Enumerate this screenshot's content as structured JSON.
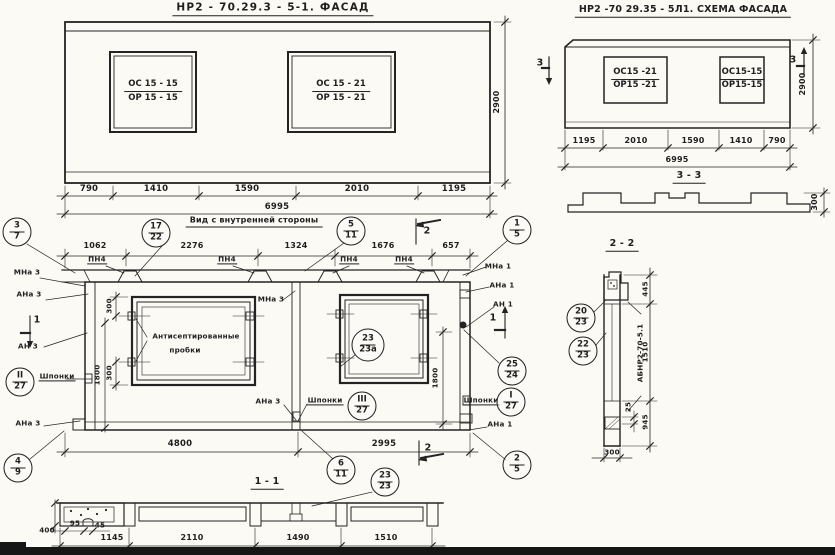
{
  "facade": {
    "title": "НР2 - 70.29.3  - 5-1. ФАСАД",
    "win1": {
      "top": "ОС 15 - 15",
      "bot": "ОР 15 - 15"
    },
    "win2": {
      "top": "ОС 15 - 21",
      "bot": "ОР 15 - 21"
    },
    "dims": [
      "790",
      "1410",
      "1590",
      "2010",
      "1195"
    ],
    "total": "6995",
    "height": "2900"
  },
  "scheme": {
    "title": "НР2 -70 29.35 - 5Л1. СХЕМА ФАСАДА",
    "win1": {
      "top": "ОС15 -21",
      "bot": "ОР15 -21"
    },
    "win2": {
      "top": "ОС15-15",
      "bot": "ОР15-15"
    },
    "dims": [
      "1195",
      "2010",
      "1590",
      "1410",
      "790"
    ],
    "total": "6995",
    "height": "2900",
    "flag": "3"
  },
  "section33": {
    "label": "3 - 3",
    "thickness": "300"
  },
  "inner": {
    "title": "Вид с внутренней стороны",
    "top_dims": [
      "1062",
      "2276",
      "1324",
      "1676",
      "657"
    ],
    "pn4": "ПН4",
    "labels": {
      "mna3": "МНа 3",
      "ana3": "АНа 3",
      "an3": "АН 3",
      "mna1": "МНа 1",
      "ana1": "АНа 1",
      "an1": "АН 1",
      "shponki": "Шпонки"
    },
    "note_line1": "Антисептированные",
    "note_line2": "пробки",
    "d300": "300",
    "d1800": "1800",
    "bottom_dims": [
      "4800",
      "2995"
    ],
    "flag1": "1",
    "flag2": "2"
  },
  "balloons": {
    "b37": [
      "3",
      "7"
    ],
    "b1722": [
      "17",
      "22"
    ],
    "b511": [
      "5",
      "11"
    ],
    "b15": [
      "1",
      "5"
    ],
    "b2524": [
      "25",
      "24"
    ],
    "b127": [
      "I",
      "27"
    ],
    "b25": [
      "2",
      "5"
    ],
    "b49": [
      "4",
      "9"
    ],
    "b227": [
      "II",
      "27"
    ],
    "b327": [
      "III",
      "27"
    ],
    "b611": [
      "6",
      "11"
    ],
    "b2323": [
      "23",
      "23"
    ],
    "b2323a": [
      "23",
      "23а"
    ],
    "b2023": [
      "20",
      "23"
    ],
    "b2223": [
      "22",
      "23"
    ]
  },
  "section11": {
    "label": "1 - 1",
    "d400": "400",
    "d95": "95",
    "d45": "45",
    "dims": [
      "1145",
      "2110",
      "1490",
      "1510"
    ]
  },
  "section22": {
    "label": "2 - 2",
    "d445": "445",
    "d1510": "1510",
    "d945": "945",
    "d25": "25",
    "d300": "300",
    "mark": "АБНР2-70-5.1"
  }
}
